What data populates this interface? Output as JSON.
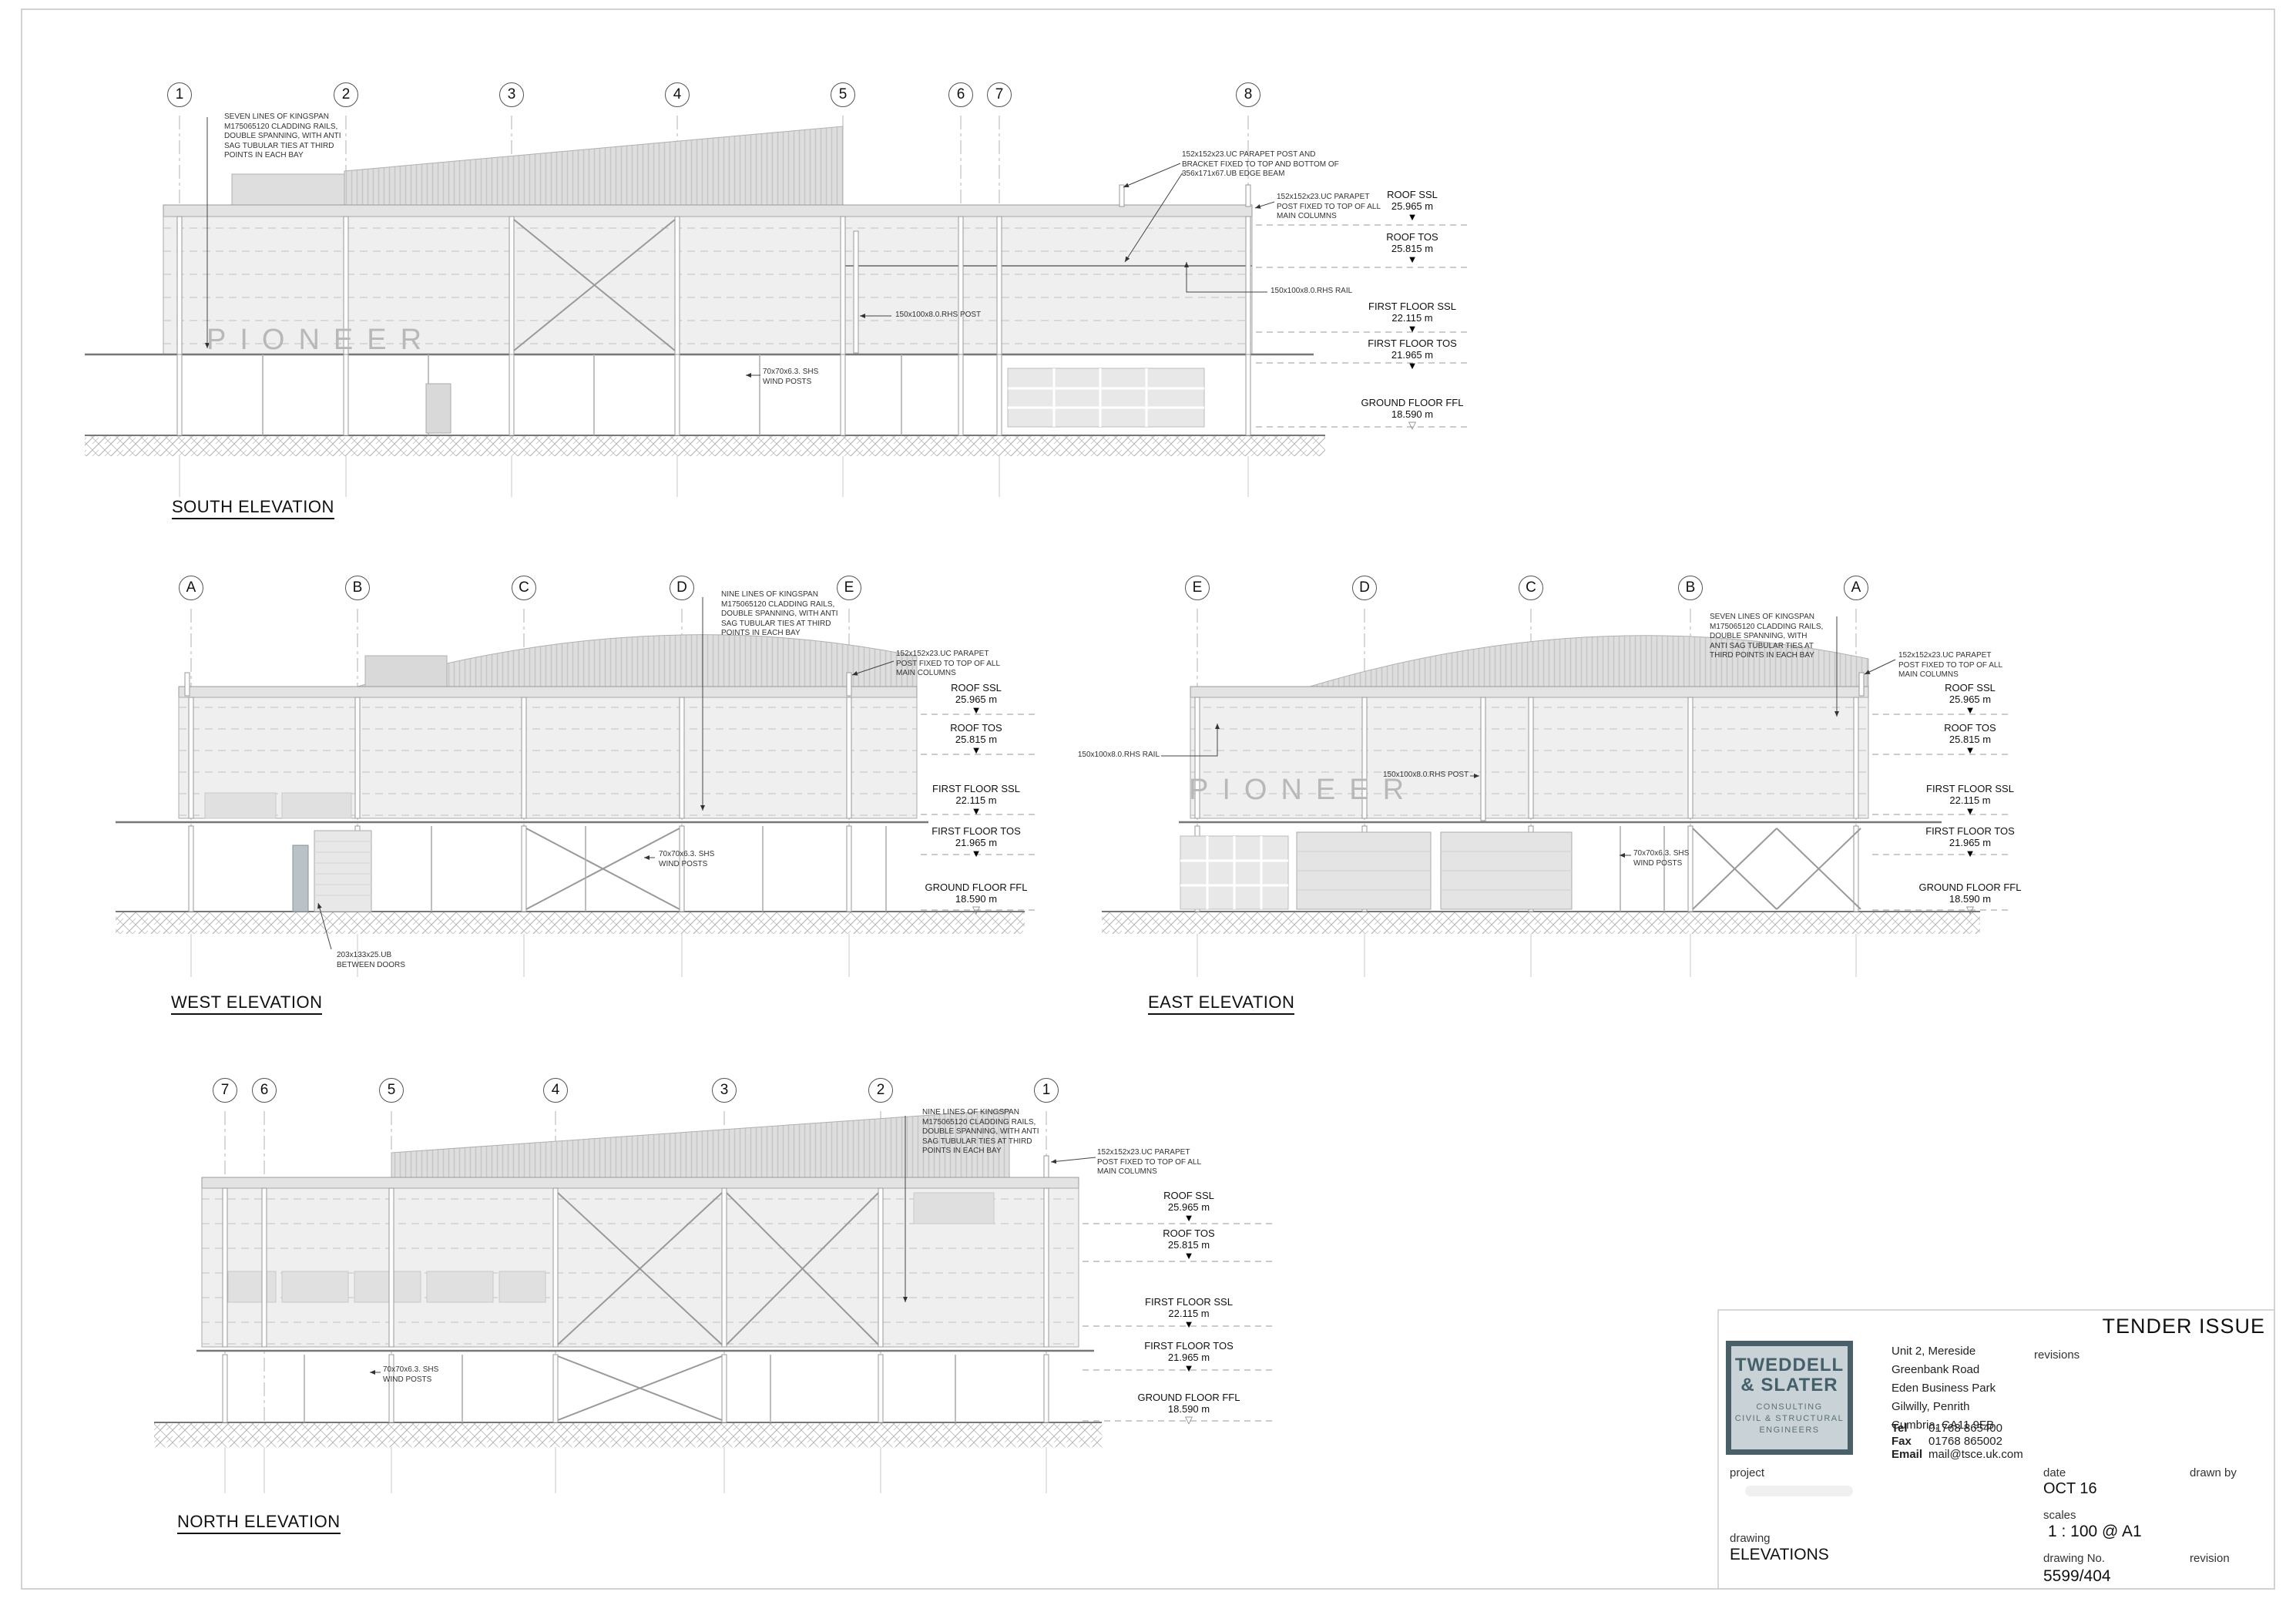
{
  "sheet": {
    "stamp": "TENDER ISSUE"
  },
  "brand": {
    "pioneer": "PIONEER"
  },
  "icons": {
    "level_marker_filled": "▼",
    "level_marker_open": "▽"
  },
  "levels": [
    {
      "label": "ROOF SSL",
      "value": "25.965 m"
    },
    {
      "label": "ROOF TOS",
      "value": "25.815 m"
    },
    {
      "label": "FIRST FLOOR SSL",
      "value": "22.115 m"
    },
    {
      "label": "FIRST FLOOR TOS",
      "value": "21.965 m"
    },
    {
      "label": "GROUND FLOOR FFL",
      "value": "18.590 m"
    }
  ],
  "notes": {
    "seven_lines": "SEVEN LINES OF KINGSPAN M175065120 CLADDING RAILS, DOUBLE SPANNING, WITH ANTI SAG TUBULAR TIES AT THIRD POINTS IN EACH BAY",
    "nine_lines": "NINE LINES OF KINGSPAN M175065120 CLADDING RAILS, DOUBLE SPANNING, WITH ANTI SAG TUBULAR TIES AT THIRD POINTS IN EACH BAY",
    "parapet_bracket": "152x152x23.UC PARAPET POST AND BRACKET FIXED TO TOP AND BOTTOM OF 356x171x67.UB EDGE BEAM",
    "parapet_post": "152x152x23.UC PARAPET POST FIXED TO TOP OF ALL MAIN COLUMNS",
    "rhs_post": "150x100x8.0.RHS POST",
    "rhs_rail": "150x100x8.0.RHS RAIL",
    "wind_posts": "70x70x6.3. SHS WIND POSTS",
    "ub_doors": "203x133x25.UB BETWEEN DOORS"
  },
  "elevations": {
    "south": {
      "title": "SOUTH ELEVATION",
      "grids": [
        "1",
        "2",
        "3",
        "4",
        "5",
        "6",
        "7",
        "8"
      ]
    },
    "west": {
      "title": "WEST ELEVATION",
      "grids": [
        "A",
        "B",
        "C",
        "D",
        "E"
      ]
    },
    "east": {
      "title": "EAST ELEVATION",
      "grids": [
        "E",
        "D",
        "C",
        "B",
        "A"
      ]
    },
    "north": {
      "title": "NORTH ELEVATION",
      "grids": [
        "7",
        "6",
        "5",
        "4",
        "3",
        "2",
        "1"
      ]
    }
  },
  "title_block": {
    "firm_name_1": "TWEDDELL",
    "firm_name_2": "& SLATER",
    "firm_sub_1": "CONSULTING",
    "firm_sub_2": "CIVIL & STRUCTURAL",
    "firm_sub_3": "ENGINEERS",
    "address": [
      "Unit 2, Mereside",
      "Greenbank Road",
      "Eden Business Park",
      "Gilwilly, Penrith",
      "Cumbria, CA11 9FB"
    ],
    "tel_label": "Tel",
    "tel": "01768 865400",
    "fax_label": "Fax",
    "fax": "01768 865002",
    "email_label": "Email",
    "email": "mail@tsce.uk.com",
    "revisions_label": "revisions",
    "project_label": "project",
    "drawing_label": "drawing",
    "drawing": "ELEVATIONS",
    "date_label": "date",
    "date": "OCT 16",
    "drawn_by_label": "drawn by",
    "scales_label": "scales",
    "scales": "1 : 100 @ A1",
    "drawing_no_label": "drawing No.",
    "drawing_no": "5599/404",
    "revision_label": "revision"
  },
  "colors": {
    "accent_slate": "#4a6069",
    "logo_bg": "#c9d2d6",
    "line_gray": "#9a9a9a",
    "wall_fill": "#efefef"
  }
}
